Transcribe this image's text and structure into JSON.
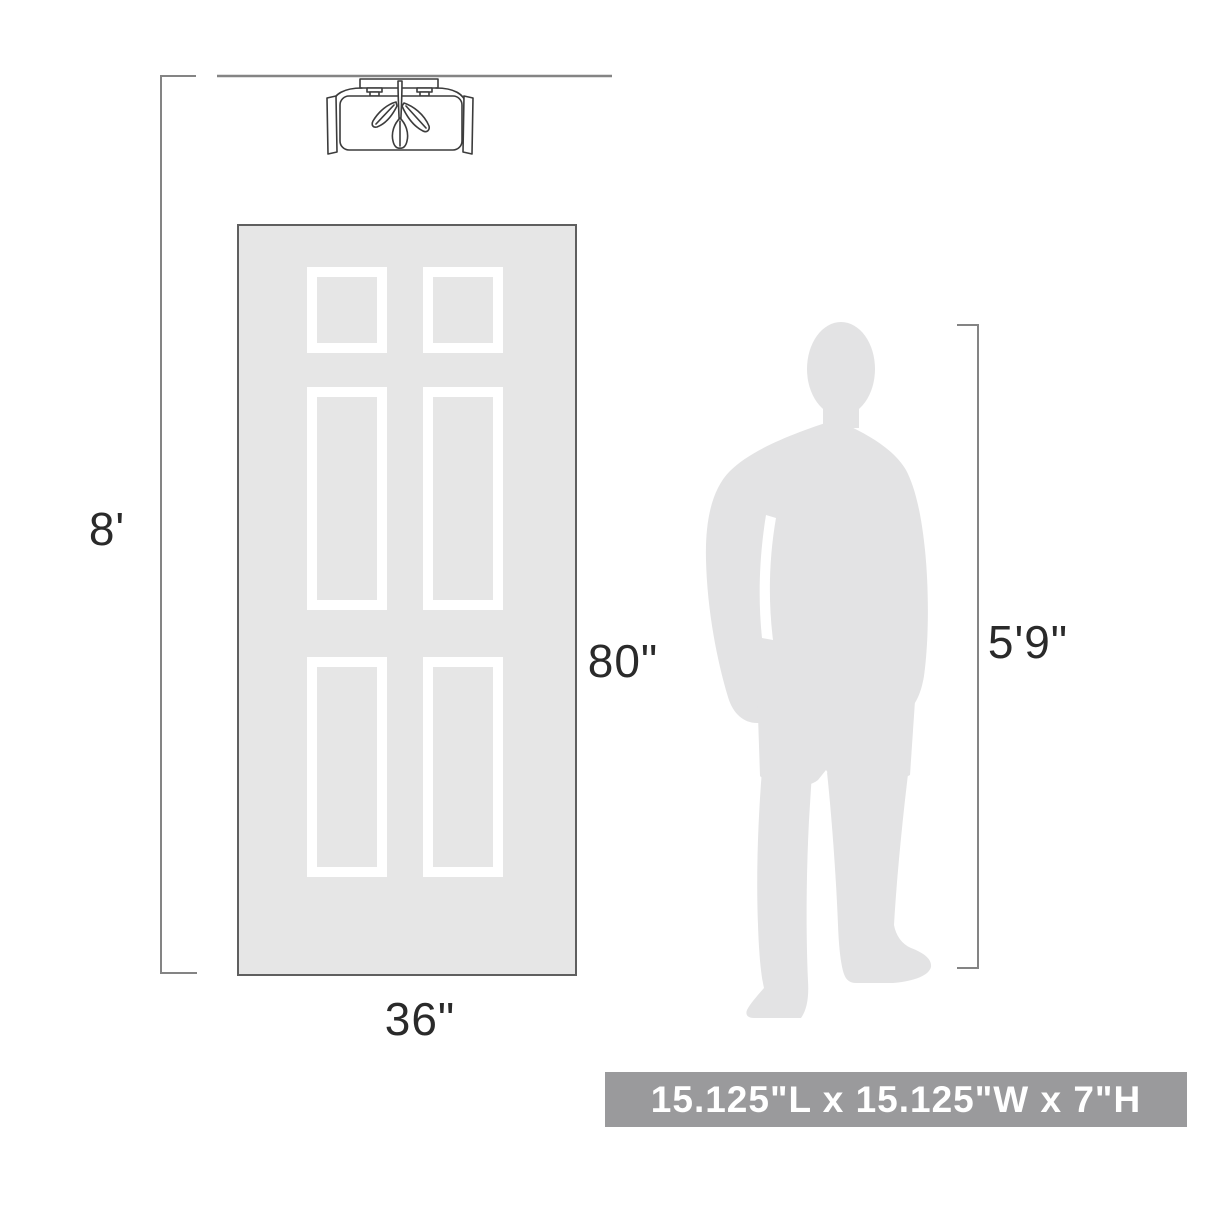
{
  "diagram": {
    "labels": {
      "ceiling_height": "8'",
      "door_height": "80\"",
      "door_width": "36\"",
      "person_height": "5'9\""
    },
    "banner": {
      "text": "15.125\"L x 15.125\"W x 7\"H"
    },
    "figures": {
      "fixture": "semi-flush-mount-ceiling-light",
      "door": "six-panel-door",
      "person": "standing-man-silhouette"
    }
  },
  "colors": {
    "silhouette_gray": "#e3e3e4",
    "door_fill": "#e6e6e6",
    "door_border": "#5f5f5f",
    "dimension_line": "#848484",
    "fixture_line": "#3c3c3c",
    "label_text": "#2a2a2a",
    "banner_background": "#9a9a9c",
    "banner_text": "#ffffff"
  }
}
